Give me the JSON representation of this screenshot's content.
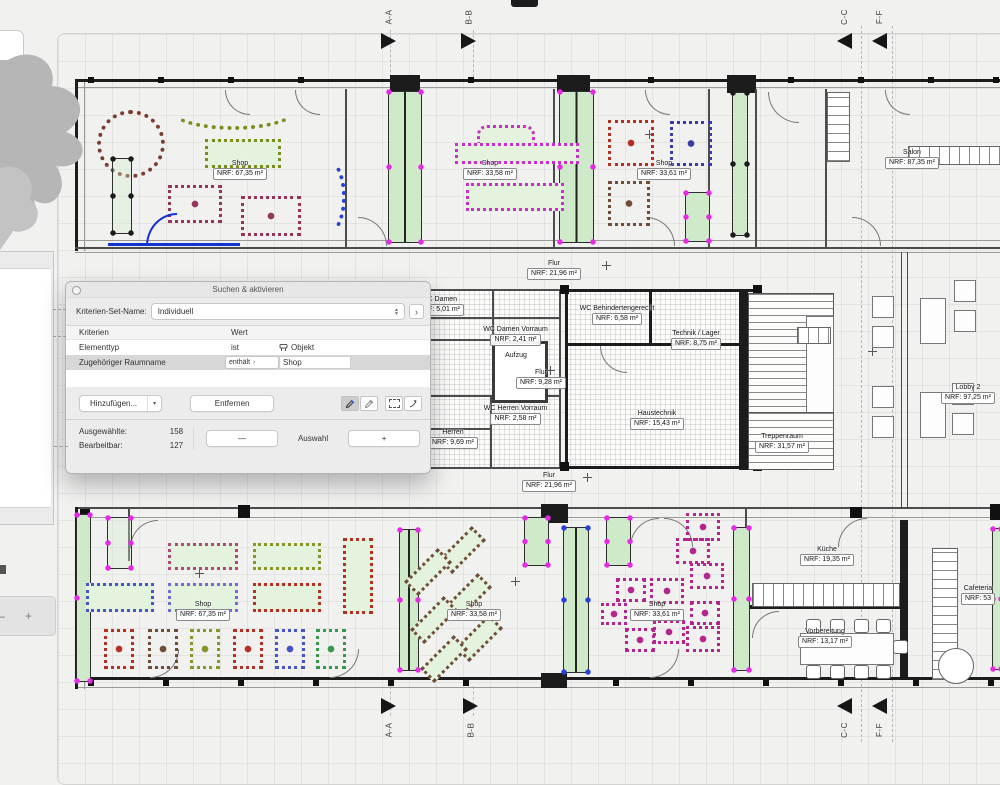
{
  "dialog": {
    "title": "Suchen & aktivieren",
    "criteria_set_label": "Kriterien-Set-Name:",
    "criteria_set_value": "Individuell",
    "columns": {
      "criteria": "Kriterien",
      "value": "Wert"
    },
    "rows": [
      {
        "name": "Elementtyp",
        "operator": "ist",
        "value": "Objekt"
      },
      {
        "name": "Zugehöriger Raumname",
        "operator": "enthält",
        "value": "Shop"
      }
    ],
    "buttons": {
      "add": "Hinzufügen...",
      "remove": "Entfernen",
      "minus": "—",
      "selection": "Auswahl",
      "plus": "+"
    },
    "stats": [
      {
        "label": "Ausgewählte:",
        "value": "158"
      },
      {
        "label": "Bearbeitbar:",
        "value": "127"
      }
    ]
  },
  "icons": {
    "disclosure": "›",
    "add_menu": "▾",
    "close": "circle",
    "stepper": "up-down-arrows",
    "eyedropper": "eyedropper",
    "eyedropper_inject": "eyedropper-alt",
    "marquee": "dashed-rect",
    "arrow": "bent-arrow",
    "object": "object-glyph"
  },
  "zoom_controls": {
    "minus": "—",
    "plus": "+"
  },
  "section_markers": [
    {
      "label": "A-A"
    },
    {
      "label": "B-B"
    },
    {
      "label": "C-C"
    },
    {
      "label": "F-F"
    },
    {
      "label": "A-A"
    },
    {
      "label": "B-B"
    },
    {
      "label": "C-C"
    },
    {
      "label": "F-F"
    }
  ],
  "rooms": [
    {
      "name": "Shop",
      "area": "NRF: 67,35 m²"
    },
    {
      "name": "Shop",
      "area": "NRF: 33,58 m²"
    },
    {
      "name": "Shop",
      "area": "NRF: 33,61 m²"
    },
    {
      "name": "Salon",
      "area": "NRF: 87,35 m²"
    },
    {
      "name": "Flur",
      "area": "NRF: 21,96 m²"
    },
    {
      "name": "WC Damen",
      "area": "NRF: 5,01 m²"
    },
    {
      "name": "WC Damen Vorraum",
      "area": "NRF: 2,41 m²"
    },
    {
      "name": "WC Behindertengerecht",
      "area": "NRF: 6,58 m²"
    },
    {
      "name": "Technik / Lager",
      "area": "NRF: 8,75 m²"
    },
    {
      "name": "Aufzug",
      "area": ""
    },
    {
      "name": "Flur",
      "area": "NRF: 9,28 m²"
    },
    {
      "name": "WC Herren Vorraum",
      "area": "NRF: 2,58 m²"
    },
    {
      "name": "Herren",
      "area": "NRF: 9,69 m²"
    },
    {
      "name": "Haustechnik",
      "area": "NRF: 15,43 m²"
    },
    {
      "name": "Treppenraum",
      "area": "NRF: 31,57 m²"
    },
    {
      "name": "Lobby 2",
      "area": "NRF: 97,25 m²"
    },
    {
      "name": "Flur",
      "area": "NRF: 21,96 m²"
    },
    {
      "name": "Shop",
      "area": "NRF: 67,35 m²"
    },
    {
      "name": "Shop",
      "area": "NRF: 33,58 m²"
    },
    {
      "name": "Shop",
      "area": "NRF: 33,61 m²"
    },
    {
      "name": "Küche",
      "area": "NRF: 19,35 m²"
    },
    {
      "name": "Vorbereitung",
      "area": "NRF: 13,17 m²"
    },
    {
      "name": "Cafeteria",
      "area": "NRF: 53"
    }
  ],
  "colors": {
    "selection_fill": "#cfeac8",
    "selection_handle": "#e52ae5",
    "selected_wall_blue": "#1433d6",
    "canvas_bg": "#f1f1f0"
  }
}
